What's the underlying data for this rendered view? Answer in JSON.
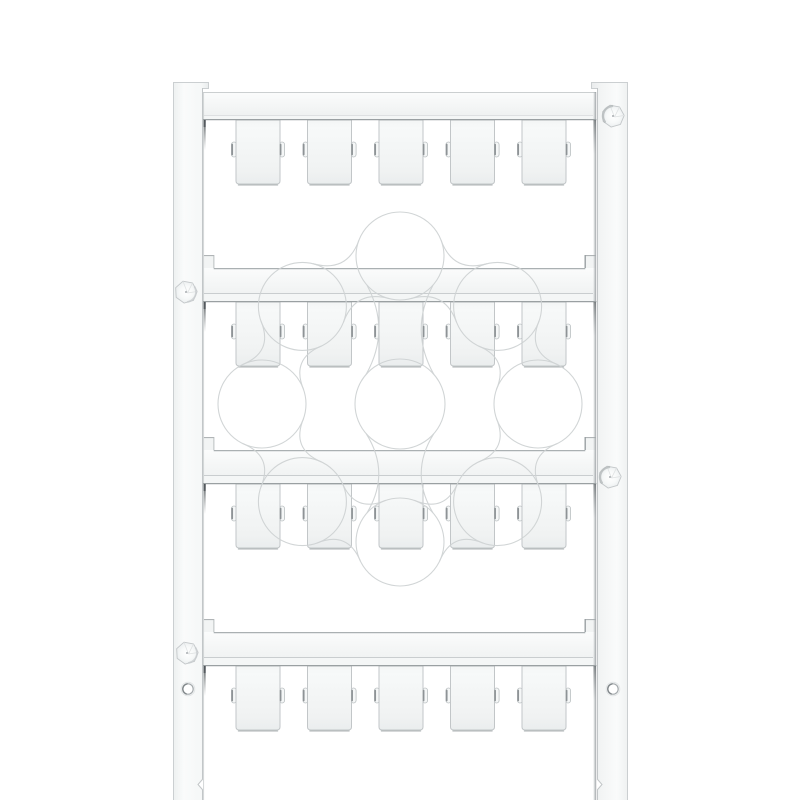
{
  "product": {
    "type": "terminal-marker-card",
    "aria_label": "White plastic terminal marker card with four rows of five blank markers held between two side rails",
    "rows": 4,
    "markers_per_row": 5,
    "total_markers": 20
  },
  "colors": {
    "background": "#ffffff",
    "edge_light": "#cbcfd1",
    "edge_mid": "#aab0b2",
    "edge_dark": "#9aa0a2",
    "corner_dark": "#50565a",
    "tag_stroke": "#c2c6c8",
    "tag_shadow": "#b2b7b9",
    "nub_fill": "#f5f7f7",
    "nub_stroke": "#bbc0c2",
    "nub_dark": "#8e9396",
    "block_fill": "#f2f4f4",
    "block_edge": "#a8adaf",
    "block_edge_dark": "#9aa0a3",
    "strip_fill": "#f4f6f6",
    "subline": "#c9cdcf",
    "subline_light": "#dadcdd",
    "rail_line": "#c2c6c8",
    "card_edge": "#c9cdce",
    "hole_ring": "#a4a9ac",
    "hole_dark": "#81878a",
    "hole_halo": "#e2e5e6",
    "pin_stroke": "#c3c7c9",
    "pin_facet": "#dfe2e3",
    "pin_shade_dark": "#b5babc",
    "pin_shade_soft": "#c9cdcf",
    "pin_dot": "#a9aeb1",
    "watermark_line": "#ced2d3",
    "gradients": {
      "bar": [
        [
          "0",
          "#fbfcfc"
        ],
        [
          "0.72",
          "#f1f3f3"
        ],
        [
          "1",
          "#edeff0"
        ]
      ],
      "tag": [
        [
          "0",
          "#f3f5f5"
        ],
        [
          "0.12",
          "#f7f9f9"
        ],
        [
          "0.8",
          "#f0f2f2"
        ],
        [
          "1",
          "#eaedee"
        ]
      ],
      "railL": [
        [
          "0",
          "#edf0f0"
        ],
        [
          "0.3",
          "#fafbfb"
        ],
        [
          "0.8",
          "#f5f7f7"
        ],
        [
          "1",
          "#e8ebec"
        ]
      ],
      "railR": [
        [
          "0",
          "#e8ebec"
        ],
        [
          "0.25",
          "#f2f4f4"
        ],
        [
          "0.7",
          "#fafbfb"
        ],
        [
          "1",
          "#eef1f1"
        ]
      ],
      "wedge": [
        [
          "0",
          "rgba(70,76,79,0.95)"
        ],
        [
          "1",
          "rgba(120,126,129,0)"
        ]
      ],
      "band": [
        [
          "0",
          "rgba(169,174,177,0)"
        ],
        [
          "0.45",
          "rgba(169,174,177,0.5)"
        ],
        [
          "1",
          "rgba(140,146,149,0.85)"
        ]
      ],
      "pin": [
        [
          "0",
          "#ffffff"
        ],
        [
          "0.6",
          "#f7f9f9"
        ],
        [
          "1",
          "#eceff0"
        ]
      ]
    }
  },
  "geometry": {
    "canvas": {
      "w": 800,
      "h": 800
    },
    "rails": {
      "left": {
        "outer": 173,
        "inner": 203,
        "top": 82,
        "bottom": 800,
        "lip_w": 6,
        "lip_h": 6,
        "notch_y1": 779,
        "notch_y2": 790,
        "notch_depth": 5
      },
      "right": {
        "outer": 628,
        "inner": 597,
        "top": 82,
        "bottom": 800,
        "lip_w": 6,
        "lip_h": 6,
        "notch_y1": 779,
        "notch_y2": 790,
        "notch_depth": 5
      }
    },
    "card": {
      "left": 203,
      "right": 596
    },
    "bars": [
      {
        "top": 92,
        "bottom": 120,
        "first": true
      },
      {
        "top": 268,
        "bottom": 302,
        "first": false
      },
      {
        "top": 450,
        "bottom": 484,
        "first": false
      },
      {
        "top": 632,
        "bottom": 666,
        "first": false
      }
    ],
    "windows": [
      {
        "top": 120,
        "bottom": 268
      },
      {
        "top": 302,
        "bottom": 450
      },
      {
        "top": 484,
        "bottom": 632
      },
      {
        "top": 666,
        "bottom": 800
      }
    ],
    "block": {
      "w": 10.2,
      "h": 13
    },
    "tags": {
      "lefts": [
        236,
        307.5,
        379,
        450.5,
        522
      ],
      "width": 44,
      "height": 64,
      "nub_dy": 22,
      "nub_h": 15,
      "nub_w": 5.2
    },
    "pins": [
      {
        "cx": 613,
        "cy": 116,
        "shade": "tl"
      },
      {
        "cx": 186,
        "cy": 292,
        "shade": "br"
      },
      {
        "cx": 610,
        "cy": 477,
        "shade": "tl"
      },
      {
        "cx": 187,
        "cy": 653,
        "shade": "br"
      }
    ],
    "pin_r": 11.2,
    "holes": [
      {
        "cx": 188,
        "cy": 689
      },
      {
        "cx": 613,
        "cy": 689
      }
    ],
    "hole_r": 5.2,
    "watermark": {
      "cx": 400,
      "cy": 404,
      "center_r": 45,
      "circle_r": 44,
      "ring_r": 138,
      "top_ring_r": 148,
      "ring_count": 8,
      "neck_halfwidth": 9,
      "stroke_width": 1.1
    }
  }
}
